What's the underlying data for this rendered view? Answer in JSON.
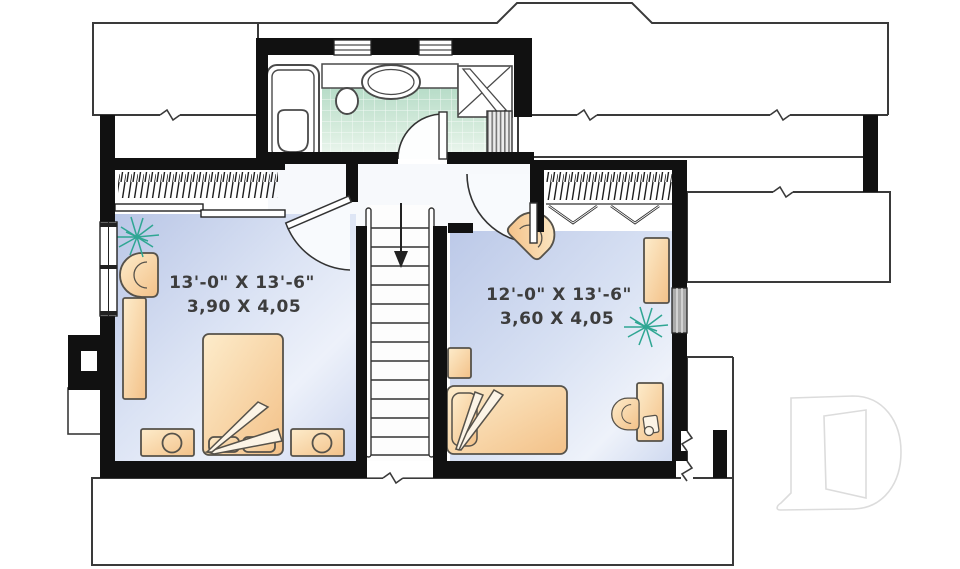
{
  "plan": {
    "title": "upper-floor-plan",
    "rooms": [
      {
        "id": "bedroom-left",
        "dim_imperial": "13'-0\" X 13'-6\"",
        "dim_metric": "3,90 X 4,05"
      },
      {
        "id": "bedroom-right",
        "dim_imperial": "12'-0\" X 13'-6\"",
        "dim_metric": "3,60 X 4,05"
      }
    ],
    "stairs": {
      "icon": "stairs-down-arrow-icon"
    },
    "fixture_icons": [
      "bathtub-icon",
      "toilet-icon",
      "sink-icon",
      "corner-shower-icon",
      "linen-closet",
      "window-icon",
      "bifold-door-icon",
      "plant-icon"
    ],
    "furniture_icons": [
      "double-bed",
      "single-bed",
      "nightstand",
      "table-lamp-icon",
      "dresser",
      "wardrobe",
      "armchair",
      "desk",
      "desk-chair",
      "desk-lamp-icon"
    ],
    "logo": {
      "icon": "drummond-d-logo-icon"
    },
    "colors": {
      "wall": "#111111",
      "outline": "#3a3a3a",
      "floor_blue": "#c3cfeb",
      "floor_blue_light": "#edf1fa",
      "tile_green": "#bfe0cd",
      "tile_green_light": "#ecf7ef",
      "furniture_orange": "#f6c88f",
      "furniture_orange_light": "#fdeccb",
      "plant_teal": "#2fa693",
      "logo_gray": "#dcdcdc"
    }
  }
}
